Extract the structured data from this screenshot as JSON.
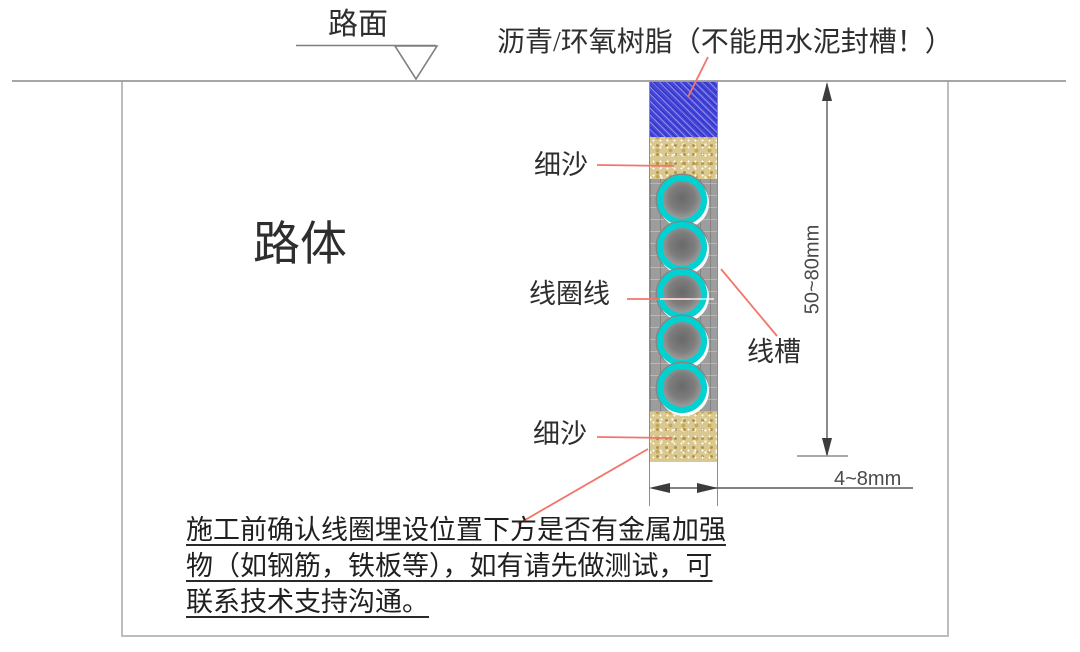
{
  "diagram": {
    "road_surface_label": "路面",
    "seal_label": "沥青/环氧树脂（不能用水泥封槽！）",
    "road_body_label": "路体",
    "fine_sand_top_label": "细沙",
    "coil_wire_label": "线圈线",
    "slot_label": "线槽",
    "fine_sand_bottom_label": "细沙",
    "depth_dimension_label": "50~80mm",
    "width_dimension_label": "4~8mm",
    "warning_lines": [
      "施工前确认线圈埋设位置下方是否有金属加强",
      "物（如钢筋，铁板等），如有请先做测试，可",
      "联系技术支持沟通。"
    ],
    "coil_count": 5,
    "colors": {
      "seal_fill": "#4646da",
      "sand_fill": "#d9c88f",
      "slot_fill": "#9d9d9d",
      "coil_ring": "#00d2d2",
      "leader_line": "#f2756b",
      "drawing_line": "#8d8d8d"
    }
  }
}
